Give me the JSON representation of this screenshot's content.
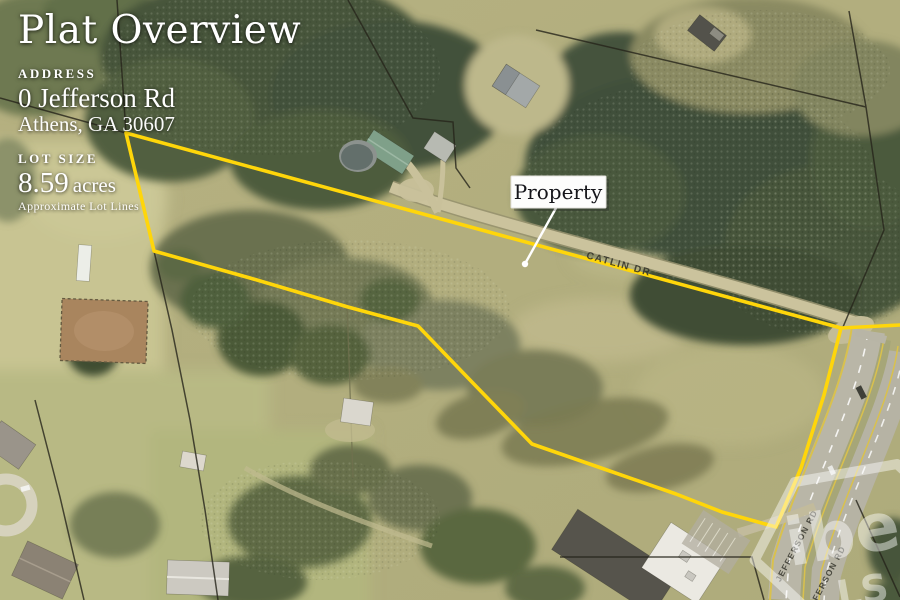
{
  "overlay": {
    "title": "Plat Overview",
    "address": {
      "label": "ADDRESS",
      "line1": "0 Jefferson Rd",
      "line2": "Athens, GA 30607"
    },
    "lot": {
      "label": "LOT SIZE",
      "value": "8.59",
      "unit": "acres",
      "note": "Approximate Lot Lines"
    }
  },
  "callout": {
    "label": "Property"
  },
  "map": {
    "boundary": {
      "color": "#ffd60a",
      "points": "126,133 841,328 824,395 801,468 776,527 722,512 676,494 604,469 532,444 470,380 418,326 348,307 250,278 154,251 126,133",
      "tail_points": "841,328 900,325"
    },
    "road_labels": {
      "catlin": "CATLIN DR",
      "jefferson": "JEFFERSON RD"
    },
    "watermark": {
      "line1": "ibe",
      "line2": "LS"
    }
  }
}
